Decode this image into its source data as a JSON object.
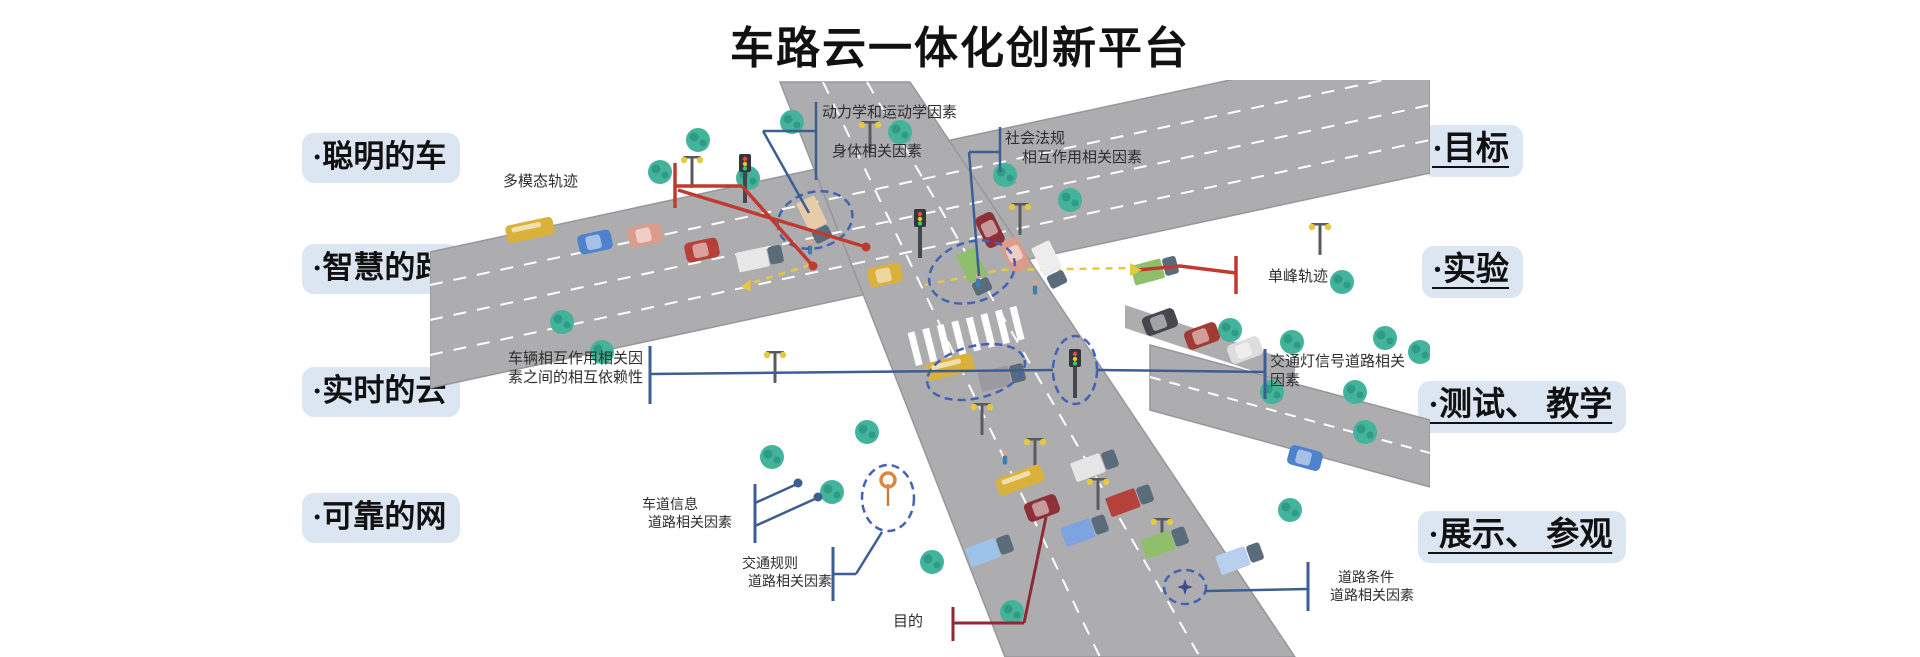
{
  "title": "车路云一体化创新平台",
  "left_panel": {
    "items": [
      {
        "label": "·聪明的车"
      },
      {
        "label": "·智慧的路"
      },
      {
        "label": "·实时的云"
      },
      {
        "label": "·可靠的网"
      }
    ]
  },
  "right_panel": {
    "items": [
      {
        "label": "·目标"
      },
      {
        "label": "·实验"
      },
      {
        "label": "·测试、 教学"
      },
      {
        "label": "·展示、 参观"
      }
    ]
  },
  "diagram": {
    "annotations": {
      "dynamics": {
        "line1": "动力学和运动学因素"
      },
      "body": {
        "line1": "身体相关因素"
      },
      "social": {
        "line1": "社会法规",
        "line2": "相互作用相关因素"
      },
      "multimodal": {
        "line1": "多模态轨迹"
      },
      "interdependence": {
        "line1": "车辆相互作用相关因",
        "line2": "素之间的相互依赖性"
      },
      "lane_info": {
        "line1": "车道信息",
        "line2": "道路相关因素"
      },
      "traffic_rules": {
        "line1": "交通规则",
        "line2": "道路相关因素"
      },
      "purpose": {
        "line1": "目的"
      },
      "unimodal": {
        "line1": "单峰轨迹"
      },
      "traffic_light": {
        "line1": "交通灯信号道路相关",
        "line2": "因素"
      },
      "road_condition": {
        "line1": "道路条件",
        "line2": "道路相关因素"
      }
    },
    "colors": {
      "pill-bg": "#dce5f2",
      "ink": "#111111",
      "annotation-ink": "#2e2e2e",
      "blue-line": "#3b5f92",
      "red-line": "#c03a30",
      "dark-red-line": "#8e2a33",
      "highlight": "#4263b5",
      "road": "#adadaf",
      "road-edge": "#97979a",
      "tree": "#43b39b",
      "tree-dark": "#2e9b85",
      "lane-yellow": "#e8c83c",
      "zebra": "#ffffff"
    }
  }
}
